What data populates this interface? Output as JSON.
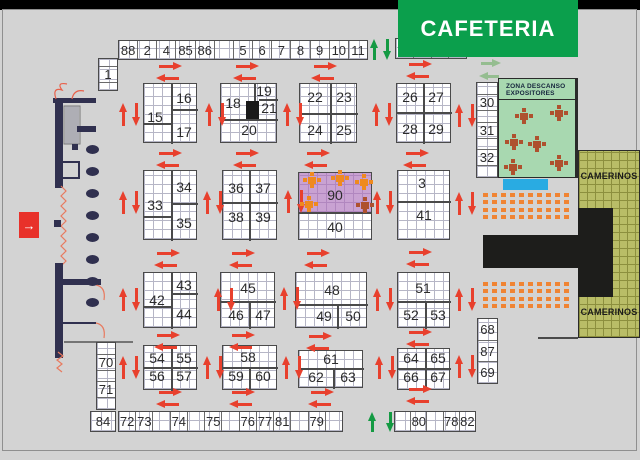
{
  "banner": {
    "cafeteria_label": "CAFETERIA"
  },
  "zona_descanso": {
    "title_line1": "ZONA DESCANSO",
    "title_line2": "EXPOSITORES"
  },
  "camerinos": {
    "top_label": "CAMERINOS",
    "bottom_label": "CAMERINOS"
  },
  "entrance": {
    "arrow_glyph": "→"
  },
  "colors": {
    "background": "#d3d3d3",
    "top_bar": "#000000",
    "banner_green": "#0b9f4c",
    "arrow_red": "#e8402d",
    "arrow_green": "#149a43",
    "arrow_light_green": "#95bd90",
    "booth_fill": "#ffffff",
    "booth_grid_line": "#b6b6c6",
    "booth90_purple": "#c9a2d2",
    "zona_green": "#a8d8b0",
    "camerinos_olive": "#b9bd67",
    "stage_black": "#1d1d1b",
    "seat_orange": "#f08433",
    "wall_navy": "#30304f",
    "entrance_red": "#e8312a",
    "table_brick": "#ae512e",
    "table_orange": "#ef8a1f",
    "blue_marker": "#29abe2"
  },
  "strips": [
    {
      "id": "top-strip-left",
      "x": 118,
      "y": 40,
      "w": 250,
      "h": 20,
      "cells": [
        "88",
        "2",
        "4",
        "85",
        "86",
        "",
        "5",
        "6",
        "7",
        "8",
        "9",
        "10",
        "11"
      ]
    },
    {
      "id": "top-strip-right",
      "x": 395,
      "y": 38,
      "w": 72,
      "h": 21,
      "cells": [
        "12",
        "13",
        "14",
        ""
      ]
    },
    {
      "id": "bottom-strip-left",
      "x": 118,
      "y": 411,
      "w": 225,
      "h": 21,
      "cells": [
        "72",
        "73",
        "",
        "74",
        "",
        "75",
        "",
        "76",
        "77",
        "81",
        "",
        "79",
        ""
      ]
    },
    {
      "id": "bottom-strip-right",
      "x": 394,
      "y": 411,
      "w": 82,
      "h": 21,
      "cells": [
        "",
        "80",
        "",
        "78",
        "82"
      ]
    },
    {
      "id": "booth-84",
      "x": 90,
      "y": 411,
      "w": 26,
      "h": 21,
      "cells": [
        "84"
      ]
    }
  ],
  "vstrips": [
    {
      "id": "booth-1",
      "x": 98,
      "y": 58,
      "w": 20,
      "h": 33,
      "cells": [
        "",
        "1",
        ""
      ]
    },
    {
      "id": "strip-30-31-32",
      "x": 476,
      "y": 82,
      "w": 22,
      "h": 96,
      "cells": [
        "",
        "30",
        "",
        "31",
        "",
        "32",
        ""
      ]
    },
    {
      "id": "strip-68-87-69",
      "x": 477,
      "y": 318,
      "w": 21,
      "h": 66,
      "cells": [
        "68",
        "87",
        "69"
      ]
    },
    {
      "id": "strip-70-71",
      "x": 96,
      "y": 342,
      "w": 20,
      "h": 68,
      "cells": [
        "",
        "70",
        "",
        "71",
        ""
      ]
    }
  ],
  "blocks": [
    {
      "id": "block-15-17",
      "x": 143,
      "y": 83,
      "w": 54,
      "h": 60,
      "labels": [
        {
          "t": "15",
          "x": 154,
          "y": 116
        },
        {
          "t": "16",
          "x": 183,
          "y": 97
        },
        {
          "t": "17",
          "x": 183,
          "y": 131
        }
      ],
      "dividers": [
        {
          "o": "v",
          "x": 170,
          "y1": 83,
          "y2": 143
        },
        {
          "o": "h",
          "y": 108,
          "x1": 170,
          "x2": 197
        },
        {
          "o": "h",
          "y": 122,
          "x1": 143,
          "x2": 170
        }
      ]
    },
    {
      "id": "block-18-21",
      "x": 220,
      "y": 83,
      "w": 57,
      "h": 60,
      "labels": [
        {
          "t": "18",
          "x": 232,
          "y": 102
        },
        {
          "t": "19",
          "x": 263,
          "y": 90
        },
        {
          "t": "21",
          "x": 268,
          "y": 107
        },
        {
          "t": "20",
          "x": 248,
          "y": 129
        }
      ],
      "dividers": [
        {
          "o": "h",
          "y": 118,
          "x1": 220,
          "x2": 277
        },
        {
          "o": "v",
          "x": 253,
          "y1": 83,
          "y2": 118
        },
        {
          "o": "h",
          "y": 98,
          "x1": 258,
          "x2": 277
        }
      ],
      "black_square": {
        "x": 245,
        "y": 100,
        "w": 13,
        "h": 18
      }
    },
    {
      "id": "block-22-25",
      "x": 299,
      "y": 83,
      "w": 58,
      "h": 60,
      "labels": [
        {
          "t": "22",
          "x": 314,
          "y": 96
        },
        {
          "t": "23",
          "x": 343,
          "y": 96
        },
        {
          "t": "24",
          "x": 314,
          "y": 129
        },
        {
          "t": "25",
          "x": 343,
          "y": 129
        }
      ],
      "dividers": [
        {
          "o": "v",
          "x": 329,
          "y1": 83,
          "y2": 143
        },
        {
          "o": "h",
          "y": 112,
          "x1": 299,
          "x2": 357
        }
      ]
    },
    {
      "id": "block-26-29",
      "x": 396,
      "y": 83,
      "w": 55,
      "h": 60,
      "labels": [
        {
          "t": "26",
          "x": 409,
          "y": 96
        },
        {
          "t": "27",
          "x": 435,
          "y": 96
        },
        {
          "t": "28",
          "x": 409,
          "y": 128
        },
        {
          "t": "29",
          "x": 435,
          "y": 128
        }
      ],
      "dividers": [
        {
          "o": "v",
          "x": 422,
          "y1": 83,
          "y2": 143
        },
        {
          "o": "h",
          "y": 111,
          "x1": 396,
          "x2": 451
        }
      ]
    },
    {
      "id": "block-33-35",
      "x": 143,
      "y": 170,
      "w": 54,
      "h": 70,
      "labels": [
        {
          "t": "33",
          "x": 154,
          "y": 204
        },
        {
          "t": "34",
          "x": 183,
          "y": 186
        },
        {
          "t": "35",
          "x": 183,
          "y": 222
        }
      ],
      "dividers": [
        {
          "o": "v",
          "x": 170,
          "y1": 170,
          "y2": 240
        },
        {
          "o": "h",
          "y": 202,
          "x1": 170,
          "x2": 197
        },
        {
          "o": "h",
          "y": 215,
          "x1": 143,
          "x2": 170
        }
      ]
    },
    {
      "id": "block-36-39",
      "x": 222,
      "y": 170,
      "w": 55,
      "h": 70,
      "labels": [
        {
          "t": "36",
          "x": 235,
          "y": 187
        },
        {
          "t": "37",
          "x": 262,
          "y": 187
        },
        {
          "t": "38",
          "x": 235,
          "y": 216
        },
        {
          "t": "39",
          "x": 262,
          "y": 216
        }
      ],
      "dividers": [
        {
          "o": "v",
          "x": 248,
          "y1": 170,
          "y2": 240
        },
        {
          "o": "h",
          "y": 201,
          "x1": 222,
          "x2": 277
        }
      ]
    },
    {
      "id": "block-90",
      "x": 298,
      "y": 172,
      "w": 74,
      "h": 41,
      "purple": true,
      "labels": [
        {
          "t": "90",
          "x": 334,
          "y": 194
        }
      ]
    },
    {
      "id": "block-40",
      "x": 298,
      "y": 213,
      "w": 74,
      "h": 27,
      "labels": [
        {
          "t": "40",
          "x": 334,
          "y": 226
        }
      ]
    },
    {
      "id": "block-3-41",
      "x": 397,
      "y": 170,
      "w": 53,
      "h": 70,
      "labels": [
        {
          "t": "3",
          "x": 421,
          "y": 182
        },
        {
          "t": "41",
          "x": 423,
          "y": 214
        }
      ],
      "dividers": [
        {
          "o": "h",
          "y": 200,
          "x1": 397,
          "x2": 450
        }
      ]
    },
    {
      "id": "block-42-44",
      "x": 143,
      "y": 272,
      "w": 54,
      "h": 56,
      "labels": [
        {
          "t": "42",
          "x": 156,
          "y": 299
        },
        {
          "t": "43",
          "x": 183,
          "y": 284
        },
        {
          "t": "44",
          "x": 183,
          "y": 313
        }
      ],
      "dividers": [
        {
          "o": "v",
          "x": 170,
          "y1": 272,
          "y2": 328
        },
        {
          "o": "h",
          "y": 292,
          "x1": 170,
          "x2": 197
        },
        {
          "o": "h",
          "y": 305,
          "x1": 143,
          "x2": 170
        }
      ]
    },
    {
      "id": "block-45-47",
      "x": 220,
      "y": 272,
      "w": 55,
      "h": 56,
      "labels": [
        {
          "t": "45",
          "x": 247,
          "y": 287
        },
        {
          "t": "46",
          "x": 235,
          "y": 314
        },
        {
          "t": "47",
          "x": 262,
          "y": 314
        }
      ],
      "dividers": [
        {
          "o": "h",
          "y": 300,
          "x1": 220,
          "x2": 275
        },
        {
          "o": "v",
          "x": 248,
          "y1": 300,
          "y2": 328
        }
      ]
    },
    {
      "id": "block-48-50",
      "x": 295,
      "y": 272,
      "w": 72,
      "h": 56,
      "labels": [
        {
          "t": "48",
          "x": 331,
          "y": 289
        },
        {
          "t": "49",
          "x": 323,
          "y": 315
        },
        {
          "t": "50",
          "x": 352,
          "y": 315
        }
      ],
      "dividers": [
        {
          "o": "h",
          "y": 303,
          "x1": 295,
          "x2": 367
        },
        {
          "o": "v",
          "x": 336,
          "y1": 303,
          "y2": 328
        }
      ]
    },
    {
      "id": "block-51-53",
      "x": 397,
      "y": 272,
      "w": 53,
      "h": 56,
      "labels": [
        {
          "t": "51",
          "x": 422,
          "y": 287
        },
        {
          "t": "52",
          "x": 410,
          "y": 314
        },
        {
          "t": "53",
          "x": 437,
          "y": 314
        }
      ],
      "dividers": [
        {
          "o": "h",
          "y": 300,
          "x1": 397,
          "x2": 450
        },
        {
          "o": "v",
          "x": 424,
          "y1": 300,
          "y2": 328
        }
      ]
    },
    {
      "id": "block-54-57",
      "x": 143,
      "y": 345,
      "w": 54,
      "h": 45,
      "labels": [
        {
          "t": "54",
          "x": 156,
          "y": 357
        },
        {
          "t": "55",
          "x": 183,
          "y": 357
        },
        {
          "t": "56",
          "x": 156,
          "y": 375
        },
        {
          "t": "57",
          "x": 183,
          "y": 375
        }
      ],
      "dividers": [
        {
          "o": "v",
          "x": 170,
          "y1": 345,
          "y2": 390
        },
        {
          "o": "h",
          "y": 366,
          "x1": 143,
          "x2": 197
        }
      ]
    },
    {
      "id": "block-58-60",
      "x": 222,
      "y": 345,
      "w": 55,
      "h": 45,
      "labels": [
        {
          "t": "58",
          "x": 247,
          "y": 356
        },
        {
          "t": "59",
          "x": 235,
          "y": 375
        },
        {
          "t": "60",
          "x": 262,
          "y": 375
        }
      ],
      "dividers": [
        {
          "o": "h",
          "y": 366,
          "x1": 222,
          "x2": 277
        },
        {
          "o": "v",
          "x": 248,
          "y1": 366,
          "y2": 390
        }
      ]
    },
    {
      "id": "block-61-63",
      "x": 298,
      "y": 350,
      "w": 65,
      "h": 38,
      "labels": [
        {
          "t": "61",
          "x": 330,
          "y": 358
        },
        {
          "t": "62",
          "x": 315,
          "y": 376
        },
        {
          "t": "63",
          "x": 347,
          "y": 376
        }
      ],
      "dividers": [
        {
          "o": "h",
          "y": 367,
          "x1": 298,
          "x2": 363
        },
        {
          "o": "v",
          "x": 332,
          "y1": 367,
          "y2": 388
        }
      ]
    },
    {
      "id": "block-64-67",
      "x": 397,
      "y": 348,
      "w": 53,
      "h": 42,
      "labels": [
        {
          "t": "64",
          "x": 410,
          "y": 357
        },
        {
          "t": "65",
          "x": 437,
          "y": 357
        },
        {
          "t": "66",
          "x": 410,
          "y": 376
        },
        {
          "t": "67",
          "x": 437,
          "y": 376
        }
      ],
      "dividers": [
        {
          "o": "v",
          "x": 424,
          "y1": 348,
          "y2": 390
        },
        {
          "o": "h",
          "y": 367,
          "x1": 397,
          "x2": 450
        }
      ]
    }
  ],
  "arrows": {
    "h_pairs_red": [
      {
        "x": 170,
        "y": 62
      },
      {
        "x": 247,
        "y": 62
      },
      {
        "x": 325,
        "y": 62
      },
      {
        "x": 420,
        "y": 60
      },
      {
        "x": 170,
        "y": 149
      },
      {
        "x": 247,
        "y": 149
      },
      {
        "x": 318,
        "y": 149
      },
      {
        "x": 417,
        "y": 149
      },
      {
        "x": 168,
        "y": 249
      },
      {
        "x": 243,
        "y": 249
      },
      {
        "x": 318,
        "y": 249
      },
      {
        "x": 420,
        "y": 248
      },
      {
        "x": 168,
        "y": 331
      },
      {
        "x": 243,
        "y": 331
      },
      {
        "x": 320,
        "y": 332
      },
      {
        "x": 420,
        "y": 328
      },
      {
        "x": 170,
        "y": 388
      },
      {
        "x": 243,
        "y": 388
      },
      {
        "x": 322,
        "y": 388
      },
      {
        "x": 420,
        "y": 385
      }
    ],
    "v_pairs_red": [
      {
        "x": 119,
        "y": 103
      },
      {
        "x": 205,
        "y": 103
      },
      {
        "x": 283,
        "y": 103
      },
      {
        "x": 372,
        "y": 103
      },
      {
        "x": 455,
        "y": 104
      },
      {
        "x": 119,
        "y": 191
      },
      {
        "x": 203,
        "y": 191
      },
      {
        "x": 284,
        "y": 190
      },
      {
        "x": 373,
        "y": 191
      },
      {
        "x": 455,
        "y": 192
      },
      {
        "x": 119,
        "y": 288
      },
      {
        "x": 214,
        "y": 288
      },
      {
        "x": 280,
        "y": 287
      },
      {
        "x": 373,
        "y": 288
      },
      {
        "x": 455,
        "y": 288
      },
      {
        "x": 119,
        "y": 356
      },
      {
        "x": 203,
        "y": 356
      },
      {
        "x": 282,
        "y": 356
      },
      {
        "x": 375,
        "y": 356
      },
      {
        "x": 455,
        "y": 355
      }
    ],
    "v_pairs_green": [
      {
        "x": 370,
        "y": 39,
        "dx": 13,
        "len": 21
      },
      {
        "x": 368,
        "y": 412,
        "dx": 18,
        "len": 20
      }
    ],
    "h_pair_light": {
      "x": 491,
      "y": 59
    }
  },
  "seating": {
    "rows": 4,
    "cols": 10,
    "blocks": [
      {
        "x": 483,
        "y": 193
      },
      {
        "x": 483,
        "y": 282
      }
    ]
  },
  "tables": {
    "zona": [
      {
        "x": 524,
        "y": 116
      },
      {
        "x": 559,
        "y": 113
      },
      {
        "x": 514,
        "y": 142
      },
      {
        "x": 537,
        "y": 144
      },
      {
        "x": 559,
        "y": 163
      },
      {
        "x": 513,
        "y": 167
      }
    ],
    "booth90": [
      {
        "x": 312,
        "y": 180
      },
      {
        "x": 340,
        "y": 178
      },
      {
        "x": 364,
        "y": 182
      },
      {
        "x": 309,
        "y": 204
      },
      {
        "x": 365,
        "y": 205,
        "brick": true
      }
    ]
  },
  "columns": {
    "cx": 92,
    "ys": [
      149,
      171,
      193,
      215,
      237,
      259,
      281,
      302
    ]
  },
  "regions": {
    "cafeteria": {
      "x": 398,
      "y": 0,
      "w": 180,
      "h": 57
    },
    "zona": {
      "x": 498,
      "y": 78,
      "w": 80,
      "h": 100
    },
    "camerinos": {
      "x": 578,
      "y": 150,
      "w": 62,
      "h": 188
    },
    "stage_bar": {
      "x": 483,
      "y": 235,
      "w": 97,
      "h": 33
    },
    "stage_head": {
      "x": 578,
      "y": 208,
      "w": 35,
      "h": 89
    },
    "blue_marker": {
      "x": 503,
      "y": 179,
      "w": 45,
      "h": 11
    },
    "entrance_box": {
      "x": 19,
      "y": 212,
      "w": 20,
      "h": 26
    }
  }
}
